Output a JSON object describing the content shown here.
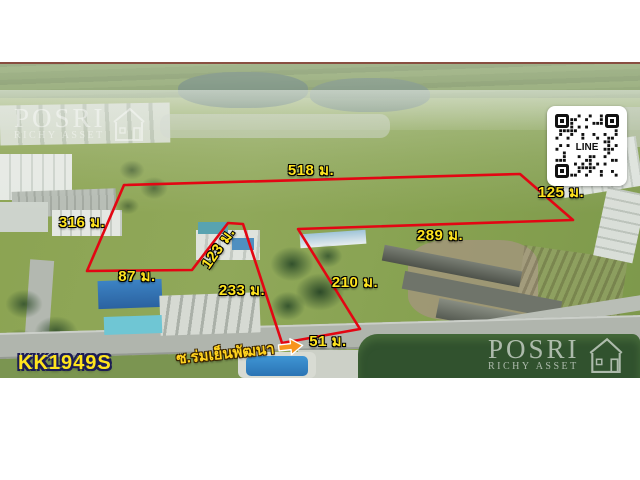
{
  "listing": {
    "code": "KK1949S",
    "soi": "ซ.ร่มเย็นพัฒนา"
  },
  "measurements": [
    "518 ม.",
    "125 ม.",
    "289 ม.",
    "210 ม.",
    "51 ม.",
    "233 ม.",
    "123 ม.",
    "87 ม.",
    "316 ม."
  ],
  "watermark": {
    "brand": "POSRI",
    "subtitle": "RICHY ASSET"
  },
  "qr": {
    "label": "LINE"
  },
  "colors": {
    "boundary_red": "#e30613",
    "label_yellow": "#ffe41e",
    "arrow_orange": "#f7941d",
    "code_outline_navy": "#1c1c55"
  }
}
